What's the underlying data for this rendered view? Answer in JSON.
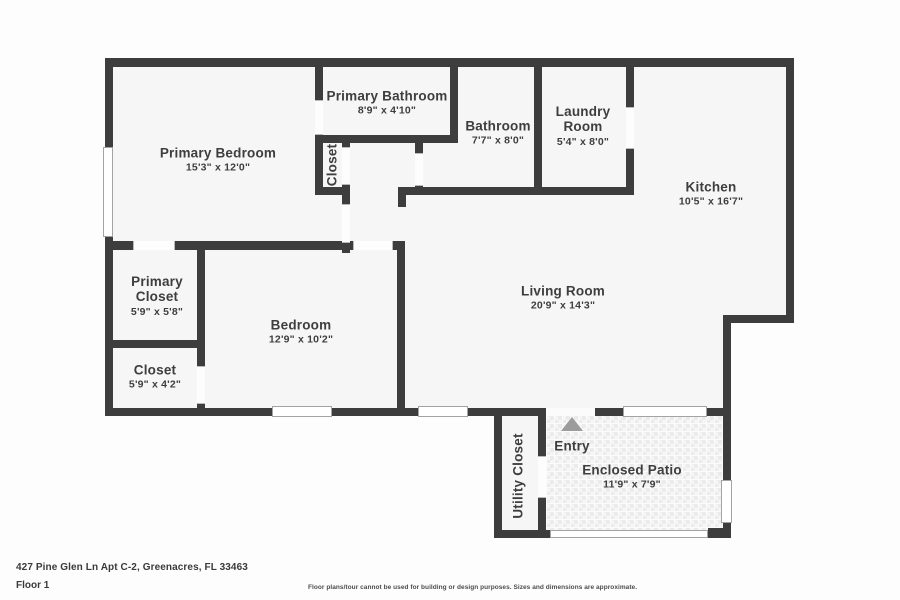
{
  "floorplan": {
    "rooms": [
      {
        "id": "primary-bedroom",
        "name": "Primary Bedroom",
        "dims": "15'3\" x 12'0\""
      },
      {
        "id": "primary-bathroom",
        "name": "Primary Bathroom",
        "dims": "8'9\" x 4'10\""
      },
      {
        "id": "bathroom",
        "name": "Bathroom",
        "dims": "7'7\" x 8'0\""
      },
      {
        "id": "laundry-room",
        "name": "Laundry Room",
        "dims": "5'4\" x 8'0\""
      },
      {
        "id": "kitchen",
        "name": "Kitchen",
        "dims": "10'5\" x 16'7\""
      },
      {
        "id": "living-room",
        "name": "Living Room",
        "dims": "20'9\" x 14'3\""
      },
      {
        "id": "primary-closet",
        "name": "Primary Closet",
        "dims": "5'9\" x 5'8\""
      },
      {
        "id": "closet",
        "name": "Closet",
        "dims": "5'9\" x 4'2\""
      },
      {
        "id": "bedroom",
        "name": "Bedroom",
        "dims": "12'9\" x 10'2\""
      },
      {
        "id": "hall-closet",
        "name": "Closet"
      },
      {
        "id": "utility-closet",
        "name": "Utility Closet"
      },
      {
        "id": "entry",
        "name": "Entry"
      },
      {
        "id": "enclosed-patio",
        "name": "Enclosed Patio",
        "dims": "11'9\" x 7'9\""
      }
    ],
    "icons": [
      {
        "id": "entry-arrow",
        "meaning": "entry direction arrow pointing up"
      }
    ],
    "colors": {
      "wall": "#3d3d3d",
      "floor": "#f6f6f6",
      "arrow": "#9c9c9c",
      "label": "#3e3e3e"
    }
  },
  "footer": {
    "address": "427 Pine Glen Ln Apt C-2, Greenacres, FL 33463",
    "floor_label": "Floor 1",
    "disclaimer": "Floor plans/tour cannot be used for building or design purposes. Sizes and dimensions are approximate."
  }
}
